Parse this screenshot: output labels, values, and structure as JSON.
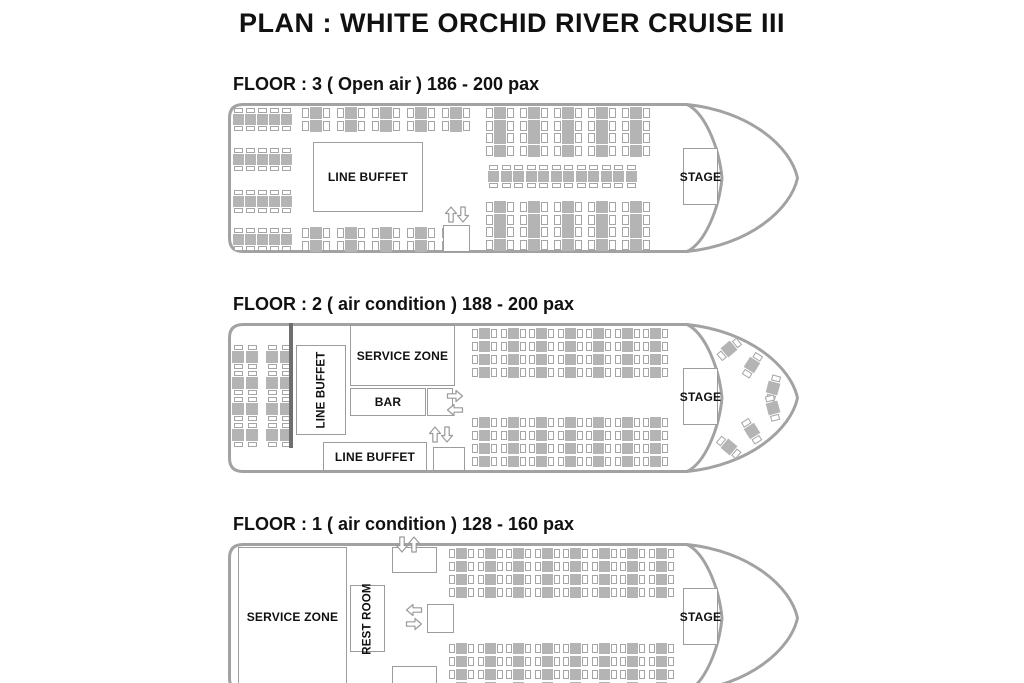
{
  "title": "PLAN : WHITE ORCHID  RIVER CRUISE III",
  "zone_labels": {
    "line_buffet": "LINE BUFFET",
    "service_zone": "SERVICE ZONE",
    "bar": "BAR",
    "rest_room": "REST ROOM",
    "stage": "STAGE"
  },
  "colors": {
    "table": "#b4b4b4",
    "chair_outline": "#a5a5a5",
    "hull_outline": "#a2a2a2",
    "wall": "#6e6e6e",
    "text": "#111111"
  },
  "floors": [
    {
      "label": "FLOOR : 3 ( Open air ) 186 - 200 pax",
      "table_groups": [
        {
          "type": "vgrid",
          "x": 233,
          "y": 108,
          "cols": 5,
          "rows": 1,
          "dx": 12,
          "dy": 0,
          "sq": 11,
          "chw": 9,
          "chh": 5
        },
        {
          "type": "vgrid",
          "x": 233,
          "y": 148,
          "cols": 5,
          "rows": 1,
          "dx": 12,
          "dy": 0,
          "sq": 11,
          "chw": 9,
          "chh": 5
        },
        {
          "type": "vgrid",
          "x": 233,
          "y": 190,
          "cols": 5,
          "rows": 1,
          "dx": 12,
          "dy": 0,
          "sq": 11,
          "chw": 9,
          "chh": 5
        },
        {
          "type": "vgrid",
          "x": 233,
          "y": 228,
          "cols": 5,
          "rows": 1,
          "dx": 12,
          "dy": 0,
          "sq": 11,
          "chw": 9,
          "chh": 5
        },
        {
          "type": "hgrid",
          "x": 302,
          "y": 107,
          "cols": 5,
          "rows": 2,
          "dx": 35,
          "dy": 12.5,
          "sq": 12,
          "chw": 7,
          "chh": 10
        },
        {
          "type": "hgrid",
          "x": 302,
          "y": 227,
          "cols": 5,
          "rows": 2,
          "dx": 35,
          "dy": 12.5,
          "sq": 12,
          "chw": 7,
          "chh": 10
        },
        {
          "type": "hgrid",
          "x": 486,
          "y": 107,
          "cols": 5,
          "rows": 4,
          "dx": 34,
          "dy": 12.6,
          "sq": 12,
          "chw": 7,
          "chh": 10
        },
        {
          "type": "vgrid",
          "x": 488,
          "y": 165,
          "cols": 12,
          "rows": 1,
          "dx": 12.5,
          "dy": 0,
          "sq": 11,
          "chw": 9,
          "chh": 5
        },
        {
          "type": "hgrid",
          "x": 486,
          "y": 201,
          "cols": 5,
          "rows": 4,
          "dx": 34,
          "dy": 12.6,
          "sq": 12,
          "chw": 7,
          "chh": 10
        }
      ],
      "stairs": [
        {
          "x": 444,
          "y": 206,
          "variant": "ud"
        }
      ]
    },
    {
      "label": "FLOOR : 2 ( air condition ) 188 - 200 pax",
      "table_groups": [
        {
          "type": "vgrid",
          "x": 232,
          "y": 345,
          "cols": 2,
          "rows": 4,
          "dx": 14,
          "dy": 26,
          "sq": 12,
          "chw": 9,
          "chh": 5
        },
        {
          "type": "vgrid",
          "x": 266,
          "y": 345,
          "cols": 2,
          "rows": 4,
          "dx": 14,
          "dy": 26,
          "sq": 12,
          "chw": 9,
          "chh": 5
        },
        {
          "type": "hgrid",
          "x": 472,
          "y": 328,
          "cols": 7,
          "rows": 4,
          "dx": 28.5,
          "dy": 13,
          "sq": 11,
          "chw": 6,
          "chh": 9
        },
        {
          "type": "hgrid",
          "x": 472,
          "y": 417,
          "cols": 7,
          "rows": 4,
          "dx": 28.5,
          "dy": 13,
          "sq": 11,
          "chw": 6,
          "chh": 9
        },
        {
          "type": "rot",
          "sq": 12,
          "chw": 6,
          "chh": 9,
          "items": [
            {
              "x": 729,
              "y": 349,
              "a": -40
            },
            {
              "x": 752,
              "y": 365,
              "a": -58
            },
            {
              "x": 773,
              "y": 388,
              "a": -75
            },
            {
              "x": 729,
              "y": 447,
              "a": 40
            },
            {
              "x": 752,
              "y": 431,
              "a": 58
            },
            {
              "x": 773,
              "y": 408,
              "a": 75
            }
          ]
        }
      ],
      "stairs": [
        {
          "x": 448,
          "y": 389,
          "variant": "rl"
        },
        {
          "x": 428,
          "y": 426,
          "variant": "ud"
        }
      ]
    },
    {
      "label": "FLOOR : 1 ( air condition ) 128 - 160 pax",
      "table_groups": [
        {
          "type": "hgrid",
          "x": 449,
          "y": 548,
          "cols": 8,
          "rows": 4,
          "dx": 28.5,
          "dy": 13,
          "sq": 11,
          "chw": 6,
          "chh": 9
        },
        {
          "type": "hgrid",
          "x": 449,
          "y": 643,
          "cols": 8,
          "rows": 4,
          "dx": 28.5,
          "dy": 13,
          "sq": 11,
          "chw": 6,
          "chh": 9
        }
      ],
      "stairs": [
        {
          "x": 395,
          "y": 536,
          "variant": "du"
        },
        {
          "x": 407,
          "y": 603,
          "variant": "lr"
        }
      ]
    }
  ]
}
